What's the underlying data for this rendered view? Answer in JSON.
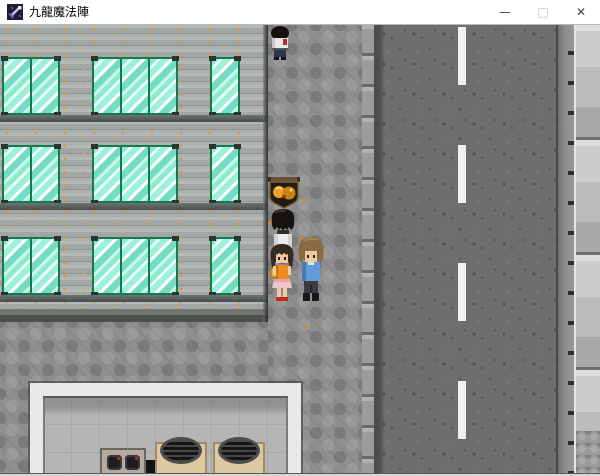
{
  "window": {
    "title": "九龍魔法陣",
    "controls": {
      "minimize": "—",
      "maximize": "□",
      "close": "✕"
    }
  },
  "colors": {
    "titlebar-bg": "#ffffff",
    "title-text": "#000000",
    "wall": "#a6aaa8",
    "window-glass": "#9df0da",
    "window-frame": "#15794e",
    "cobble": "#8f8f8f",
    "road": "#6e6e6e",
    "lane-line": "#f0f0f0",
    "curb": "#a4a4a4",
    "right-walk": "#c6c6c6",
    "room-frame": "#e9e9e9",
    "room-floor": "#b5b5b5",
    "table": "#dcc9a2",
    "sign-gold": "#e8a426"
  },
  "scene": {
    "icons": {
      "app-icon": "pixel-sword",
      "minimize-icon": "—",
      "maximize-icon": "□",
      "close-icon": "✕"
    },
    "map_features": [
      "building-facade-with-teal-windows",
      "cobblestone-sidewalk",
      "asphalt-road-with-dashed-lane-line",
      "right-side-pavement",
      "shop-interior-with-grill-tables"
    ],
    "sprites": [
      "pedestrian-walking-up",
      "hanging-shop-sign-gold-emblem",
      "black-haired-character-back-view",
      "girl-orange-top",
      "boy-blue-shirt"
    ]
  }
}
